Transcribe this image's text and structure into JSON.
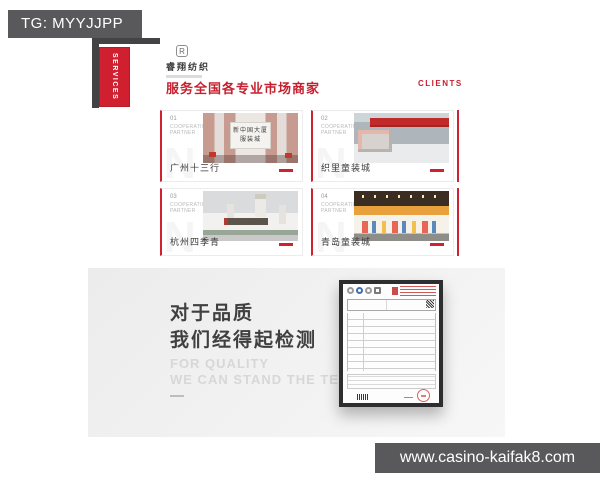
{
  "overlay": {
    "tg_label": "TG: MYYJJPP",
    "url_label": "www.casino-kaifak8.com"
  },
  "site": {
    "services_tab": "SERVICES",
    "logo": {
      "monogram": "R",
      "name": "睿翔纺织"
    },
    "heading": "服务全国各专业市场商家",
    "clients_label": "CLIENTS",
    "watermark_letter": "N",
    "cards": [
      {
        "number": "01",
        "tag_line1": "COOPERATION",
        "tag_line2": "PARTNER",
        "caption": "广州十三行",
        "sign_line1": "新中国大厦",
        "sign_line2": "服装城"
      },
      {
        "number": "02",
        "tag_line1": "COOPERATION",
        "tag_line2": "PARTNER",
        "caption": "织里童装城"
      },
      {
        "number": "03",
        "tag_line1": "COOPERATION",
        "tag_line2": "PARTNER",
        "caption": "杭州四季青"
      },
      {
        "number": "04",
        "tag_line1": "COOPERATION",
        "tag_line2": "PARTNER",
        "caption": "青岛童装城"
      }
    ],
    "quality": {
      "title_line1": "对于品质",
      "title_line2": "我们经得起检测",
      "subtitle_line1": "FOR QUALITY",
      "subtitle_line2": "WE CAN STAND THE TEST"
    }
  },
  "colors": {
    "accent_red": "#cf2230",
    "overlay_gray": "#59595b",
    "section_gray": "#efefef"
  }
}
